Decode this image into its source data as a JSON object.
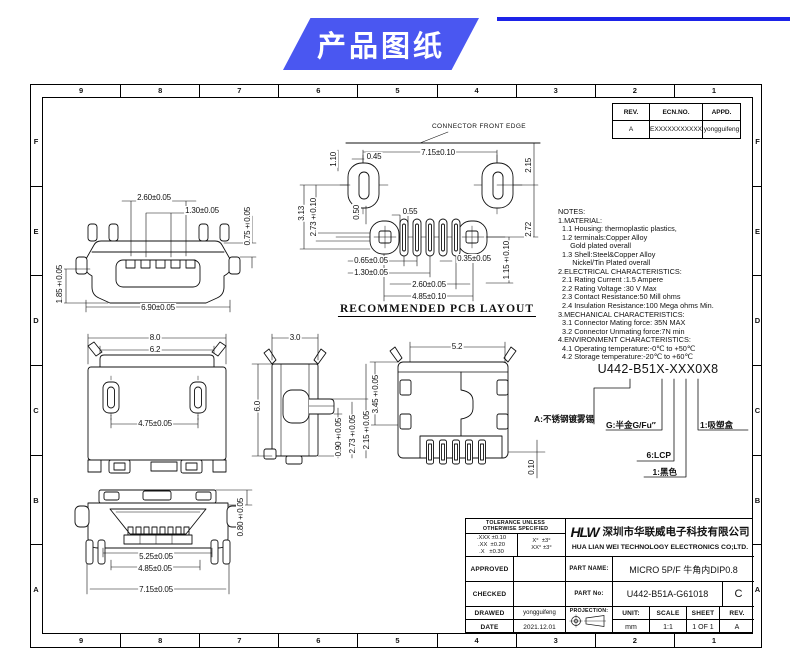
{
  "banner": {
    "title": "产品图纸",
    "bg_color": "#4a57f1",
    "line_color": "#1d23e8"
  },
  "grid": {
    "cols": [
      "9",
      "8",
      "7",
      "6",
      "5",
      "4",
      "3",
      "2",
      "1"
    ],
    "rows": [
      "F",
      "E",
      "D",
      "C",
      "B",
      "A"
    ]
  },
  "revision_table": {
    "headers": [
      "REV.",
      "ECN.NO.",
      "APPD."
    ],
    "row": [
      "A",
      "EXXXXXXXXXXX",
      "yongguifeng"
    ]
  },
  "notes": "NOTES:\n1.MATERIAL:\n  1.1 Housing: thermoplastic plastics,\n  1.2 terminals:Copper Alloy\n      Gold plated overall\n  1.3 Shell:Steel&Copper Alloy\n       Nickel/Tin Plated overall\n2.ELECTRICAL CHARACTERISTICS:\n  2.1 Rating Current :1.5 Ampere\n  2.2 Rating Voltage :30 V Max\n  2.3 Contact Resistance:50 Mill ohms\n  2.4 Insulation Resistance:100 Mega ohms Min.\n3.MECHANICAL CHARACTERISTICS:\n  3.1 Connector Mating force: 35N MAX\n  3.2 Connector Unmating force:7N min\n4.ENVIRONMENT CHARACTERISTICS:\n  4.1 Operating temperature:-0℃ to +50℃\n  4.2 Storage temperature:-20℃ to +60℃",
  "part_code": {
    "code": "U442-B51X-XXX0X8",
    "callouts": {
      "shell": "A:不锈钢镀雾锡",
      "plating": "G:半金G/Fu″",
      "material": "6:LCP",
      "color": "1:黑色",
      "packing": "1:吸塑盒"
    }
  },
  "views": {
    "pcb_caption": "RECOMMENDED PCB LAYOUT",
    "front_edge": "CONNECTOR FRONT EDGE"
  },
  "dims": {
    "front": [
      "2.60±0.05",
      "1.30±0.05",
      "0.75±0.05",
      "1.85±0.05",
      "6.90±0.05"
    ],
    "pcb": [
      "7.15±0.10",
      "0.45",
      "1.10",
      "2.15",
      "2.72",
      "3.13",
      "2.73±0.10",
      "0.50",
      "0.55",
      "0.65±0.05",
      "1.30±0.05",
      "0.35±0.05",
      "2.60±0.05",
      "4.85±0.10",
      "1.15±0.10"
    ],
    "top": [
      "8.0",
      "6.2",
      "4.75±0.05"
    ],
    "side": [
      "3.0",
      "6.0",
      "0.90±0.05",
      "2.73±0.05",
      "2.15±0.05"
    ],
    "back": [
      "5.2",
      "3.45±0.05",
      "0.10"
    ],
    "bottom": [
      "5.25±0.05",
      "4.85±0.05",
      "7.15±0.05",
      "0.80±0.05"
    ]
  },
  "title_block": {
    "tolerance_header": "TOLERANCE UNLESS\nOTHERWISE SPECIFIED",
    "tolerance_left": ".XXX ±0.10\n.XX  ±0.20\n.X   ±0.30",
    "tolerance_right": "X°  ±3°\nXX° ±3°",
    "logo": "HLW",
    "company_cn": "深圳市华联威电子科技有限公司",
    "company_en": "HUA LIAN WEI TECHNOLOGY ELECTRONICS CO;LTD.",
    "approved_label": "APPROVED",
    "checked_label": "CHECKED",
    "drawed_label": "DRAWED",
    "drawed_value": "yongguifeng",
    "date_label": "DATE",
    "date_value": "2021.12.01",
    "part_name_label": "PART NAME:",
    "part_name_value": "MICRO 5P/F 牛角内DIP0.8",
    "part_no_label": "PART No:",
    "part_no_value": "U442-B51A-G61018",
    "rev_letter": "C",
    "projection_label": "PROJECTION:",
    "unit_label": "UNIT:",
    "unit_value": "mm",
    "scale_label": "SCALE",
    "scale_value": "1:1",
    "sheet_label": "SHEET",
    "sheet_value": "1 OF 1",
    "rev_label": "REV.",
    "rev_value": "A"
  }
}
